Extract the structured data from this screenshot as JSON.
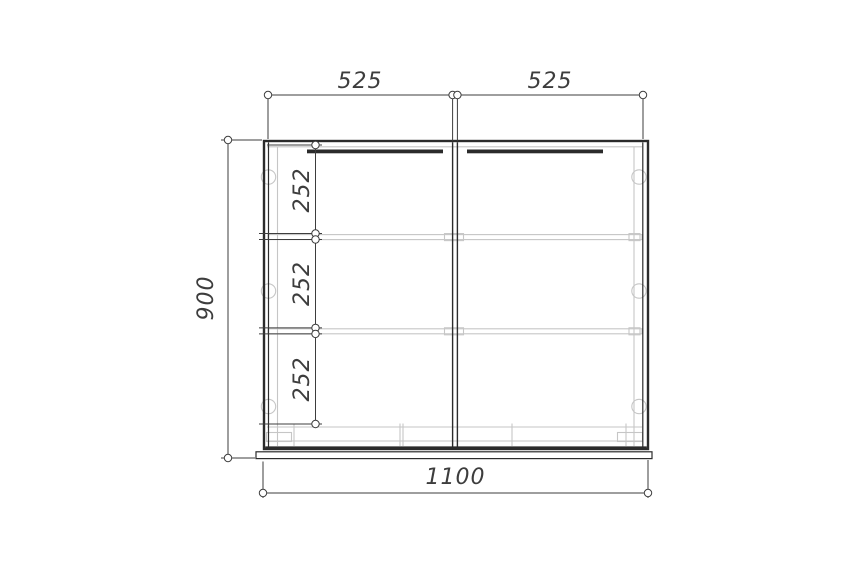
{
  "drawing": {
    "object": "two-door cabinet front elevation",
    "dim_top_left": "525",
    "dim_top_right": "525",
    "dim_height": "900",
    "dim_width": "1100",
    "dim_section_1": "252",
    "dim_section_2": "252",
    "dim_section_3": "252",
    "colors": {
      "outline": "#2b2b2b",
      "dimension": "#3d3d3d",
      "detail": "#c6c6c6",
      "background": "#ffffff"
    }
  }
}
